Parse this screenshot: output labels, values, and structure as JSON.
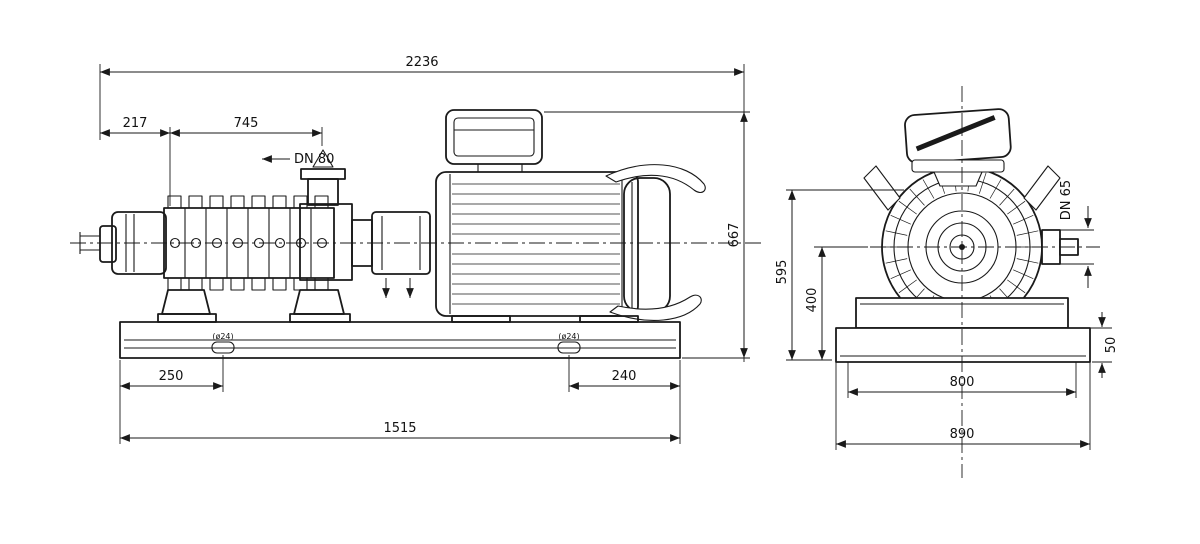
{
  "drawing": {
    "type": "pump_dimension_drawing",
    "line_color": "#1a1a1a",
    "background": "#ffffff",
    "side_view": {
      "overall_length": "2236",
      "dim_shaft_end": "217",
      "dim_suction_to_discharge": "745",
      "discharge_flange": "DN 80",
      "overall_height": "667",
      "dim_base_left": "250",
      "dim_base_right": "240",
      "base_length": "1515",
      "anchor_slot_left": "(ø24)",
      "anchor_slot_right": "(ø24)"
    },
    "end_view": {
      "overall_height": "595",
      "centerline_height": "400",
      "suction_flange": "DN 65",
      "base_height": "50",
      "base_width": "800",
      "base_width_overall": "890"
    }
  }
}
